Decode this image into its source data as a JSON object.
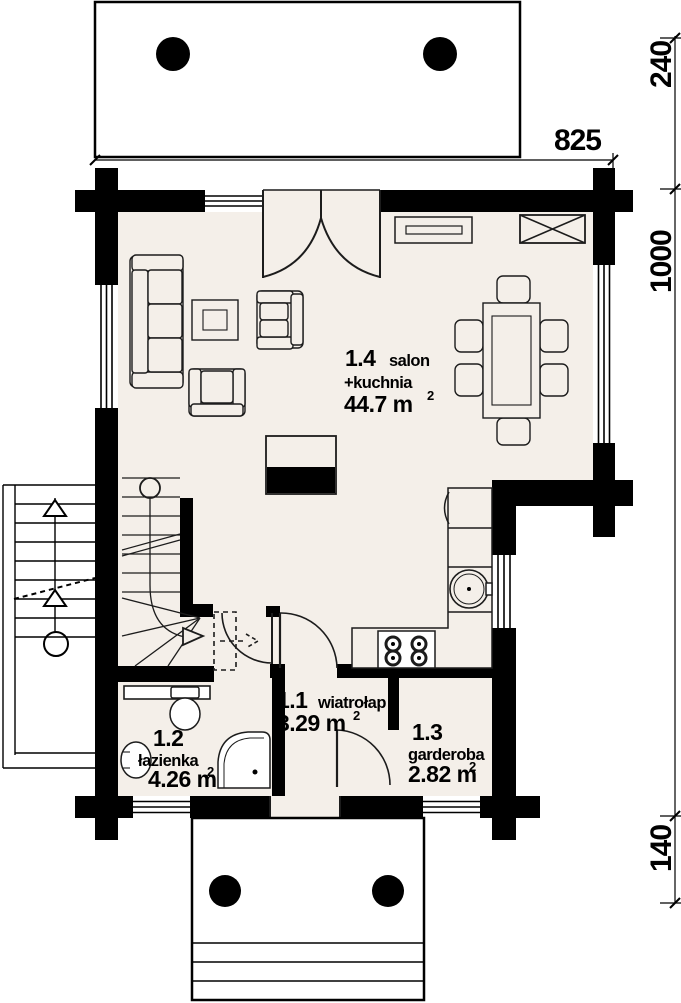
{
  "plan": {
    "rooms": [
      {
        "number": "1.4",
        "name": "salon",
        "name2": "+kuchnia",
        "area": "44.7 m",
        "area_sup": "2"
      },
      {
        "number": "1.1",
        "name": "wiatrołap",
        "area": "3.29 m",
        "area_sup": "2"
      },
      {
        "number": "1.2",
        "name": "łazienka",
        "area": "4.26 m",
        "area_sup": "2"
      },
      {
        "number": "1.3",
        "name": "garderoba",
        "area": "2.82 m",
        "area_sup": "2"
      }
    ],
    "dimensions": {
      "width": "825",
      "depth": "1000",
      "terrace_depth": "240",
      "porch_depth": "140"
    },
    "colors": {
      "wall": "#000000",
      "floor": "#f4efe9",
      "line": "#1c1c1c",
      "paper": "#ffffff"
    }
  }
}
